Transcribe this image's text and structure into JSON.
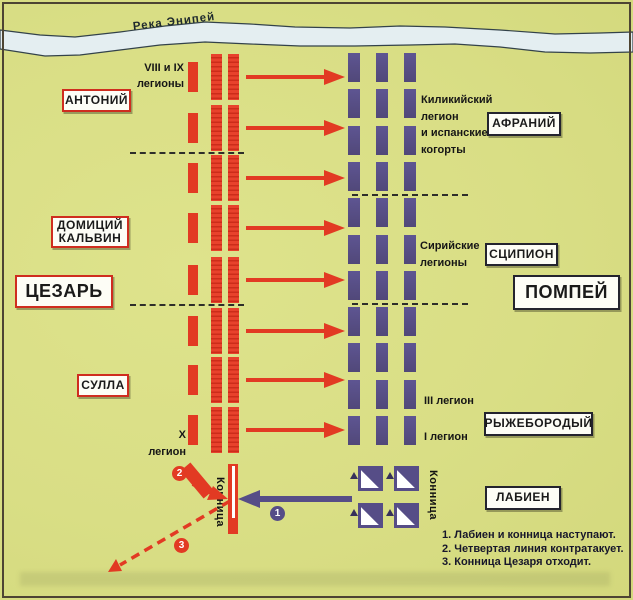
{
  "river": {
    "label": "Река Энипей"
  },
  "commanders": {
    "caesar_side": [
      {
        "id": "antony",
        "label": "АНТОНИЙ"
      },
      {
        "id": "domitius",
        "label": "ДОМИЦИЙ\nКАЛЬВИН"
      },
      {
        "id": "caesar",
        "label": "ЦЕЗАРЬ"
      },
      {
        "id": "sulla",
        "label": "СУЛЛА"
      }
    ],
    "pompey_side": [
      {
        "id": "afranius",
        "label": "АФРАНИЙ"
      },
      {
        "id": "scipio",
        "label": "СЦИПИОН"
      },
      {
        "id": "pompey",
        "label": "ПОМПЕЙ"
      },
      {
        "id": "ahenobarbus",
        "label": "РЫЖЕБОРОДЫЙ"
      },
      {
        "id": "labienus",
        "label": "ЛАБИЕН"
      }
    ]
  },
  "unit_labels": {
    "legions_8_9": "VIII и IX\nлегионы",
    "cilician": "Киликийский\nлегион\nи испанские\nкогорты",
    "syrian": "Сирийские\nлегионы",
    "legion_3": "III легион",
    "legion_1": "I легион",
    "legion_10": "X легион",
    "caesar_cavalry": "Конница",
    "pompey_cavalry": "Конница"
  },
  "legend": {
    "items": [
      "1. Лабиен и конница наступают.",
      "2. Четвертая линия контратакует.",
      "3. Конница Цезаря отходит."
    ]
  },
  "markers": {
    "m1": "1",
    "m2": "2",
    "m3": "3"
  },
  "formation": {
    "caesar_rows": 8,
    "caesar_columns_per_row": 3,
    "attack_arrows": 8,
    "pompey_columns": 3,
    "pompey_blocks_per_column": 11,
    "pompey_cavalry_squares": 4
  },
  "colors": {
    "background": "#d9de85",
    "caesar_red": "#e23a23",
    "pompey_purple": "#564d87",
    "river_blue": "#e4eef1",
    "box_background": "#fdfdf6"
  }
}
